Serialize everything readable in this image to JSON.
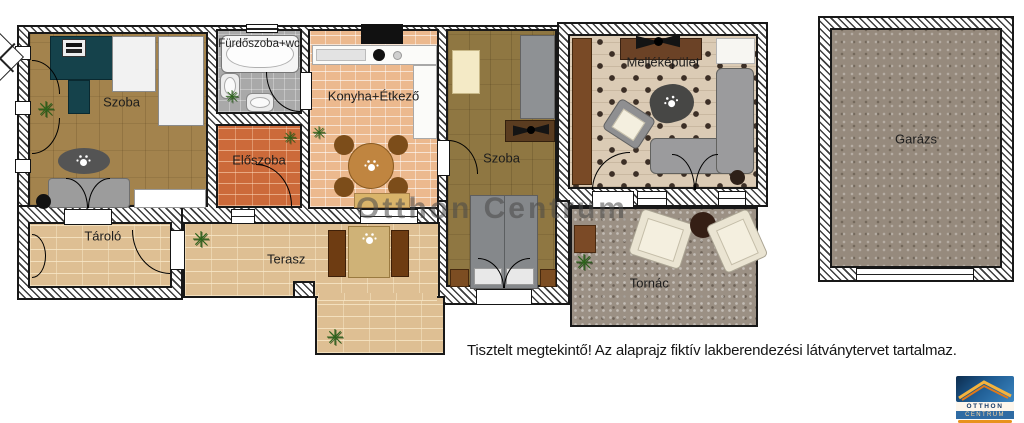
{
  "floorplan": {
    "watermark": "Otthon Centrum",
    "disclaimer": "Tisztelt megtekintő! Az alaprajz fiktív lakberendezési látványtervet tartalmaz.",
    "rooms": {
      "szoba_1": "Szoba",
      "furdoszoba": "Fürdőszoba+wc",
      "eloszoba": "Előszoba",
      "konyha_etkezo": "Konyha+Étkező",
      "szoba_2": "Szoba",
      "mellekepulet": "Melléképület",
      "garazs": "Garázs",
      "tarolo": "Tároló",
      "terasz": "Terasz",
      "tornac": "Tornác"
    },
    "icons": {
      "plant_glyph": "✳",
      "compass": "north-compass-rose",
      "oc_paw": "otthon-centrum-paw-mark"
    },
    "logo": {
      "line1": "OTTHON",
      "line2": "CENTRUM"
    },
    "colors": {
      "wall_line": "#181818",
      "wood_floor": "#a3834d",
      "wood_floor_dark": "#8f7742",
      "terracotta_tile": "#cc6a3a",
      "kitchen_tile": "#ecb98e",
      "bath_tile": "#a9a9a9",
      "brick_paving": "#debf93",
      "diamond_tile": "#dbcbb5",
      "porch_floor": "#9b9084",
      "garage_floor": "#968a7d",
      "logo_blue": "#2f6ba3",
      "logo_navy": "#173a66",
      "logo_orange": "#e8921e"
    }
  }
}
